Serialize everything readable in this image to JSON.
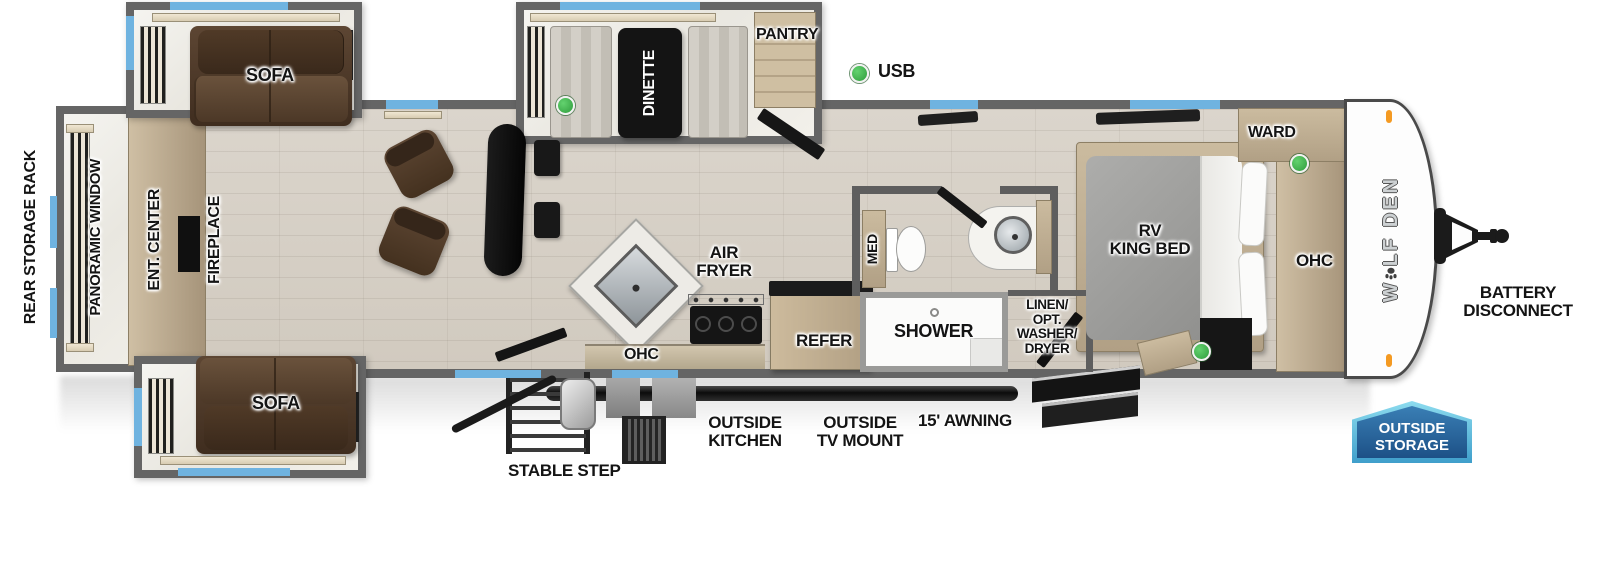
{
  "brand": {
    "prefix": "W",
    "suffix": "LF DEN"
  },
  "legend": {
    "usb": "USB"
  },
  "colors": {
    "usb_green": "#3bb54a",
    "window_blue": "#6fb3e0",
    "wall_gray": "#5e5e5e",
    "cabinet_tan": "#c0b096",
    "sofa_brown": "#4e3829",
    "badge_border_blue": "#5cc2e2",
    "badge_fill_blue": "#1d5187"
  },
  "labels": {
    "rear_storage_rack": "REAR STORAGE RACK",
    "panoramic_window": "PANORAMIC WINDOW",
    "ent_center": "ENT. CENTER",
    "fireplace": "FIREPLACE",
    "sofa_top": "SOFA",
    "sofa_bottom": "SOFA",
    "dinette": "DINETTE",
    "pantry": "PANTRY",
    "air_fryer_line1": "AIR",
    "air_fryer_line2": "FRYER",
    "kitchen_ohc": "OHC",
    "refer": "REFER",
    "med": "MED",
    "shower": "SHOWER",
    "linen_line1": "LINEN/",
    "linen_line2": "OPT.",
    "linen_line3": "WASHER/",
    "linen_line4": "DRYER",
    "rv_king_bed_line1": "RV",
    "rv_king_bed_line2": "KING BED",
    "ward": "WARD",
    "bedroom_ohc": "OHC"
  },
  "exterior": {
    "battery_line1": "BATTERY",
    "battery_line2": "DISCONNECT",
    "outside_storage_line1": "OUTSIDE",
    "outside_storage_line2": "STORAGE",
    "stable_step": "STABLE STEP",
    "outside_kitchen_line1": "OUTSIDE",
    "outside_kitchen_line2": "KITCHEN",
    "outside_tv_line1": "OUTSIDE",
    "outside_tv_line2": "TV MOUNT",
    "awning": "15' AWNING"
  }
}
